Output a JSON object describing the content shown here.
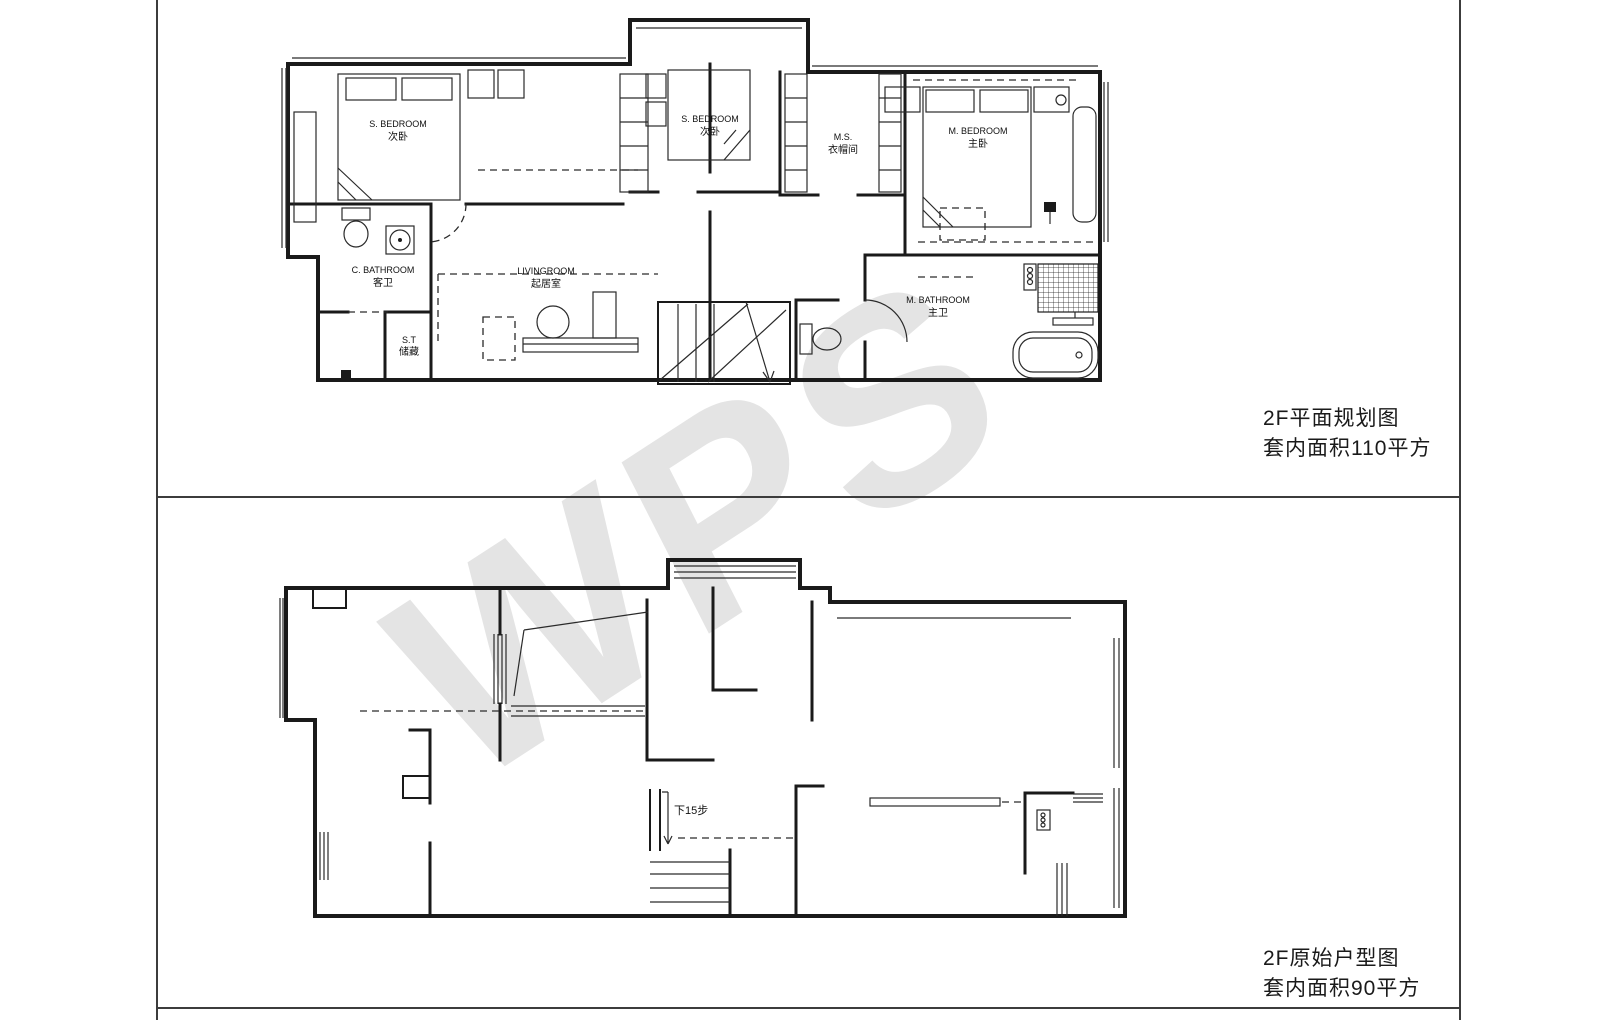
{
  "colors": {
    "wall": "#1a1a1a",
    "frame": "#3c3c3c",
    "watermark": "#e4e4e4",
    "text": "#1a1a1a"
  },
  "watermark": {
    "text": "WPS"
  },
  "captions": {
    "upper": {
      "title": "2F平面规划图",
      "area": "套内面积110平方"
    },
    "lower": {
      "title": "2F原始户型图",
      "area": "套内面积90平方"
    }
  },
  "upper_plan": {
    "name": "2F平面规划图",
    "rooms": {
      "s_bedroom_left": {
        "en": "S. BEDROOM",
        "zh": "次卧"
      },
      "s_bedroom_mid": {
        "en": "S. BEDROOM",
        "zh": "次卧"
      },
      "cloakroom": {
        "en": "M.S.",
        "zh": "衣帽间"
      },
      "m_bedroom": {
        "en": "M. BEDROOM",
        "zh": "主卧"
      },
      "c_bathroom": {
        "en": "C. BATHROOM",
        "zh": "客卫"
      },
      "storage": {
        "en": "S.T",
        "zh": "储藏"
      },
      "living": {
        "en": "LIVINGROOM",
        "zh": "起居室"
      },
      "m_bathroom": {
        "en": "M. BATHROOM",
        "zh": "主卫"
      }
    }
  },
  "lower_plan": {
    "name": "2F原始户型图",
    "stair_note": "下15步"
  }
}
